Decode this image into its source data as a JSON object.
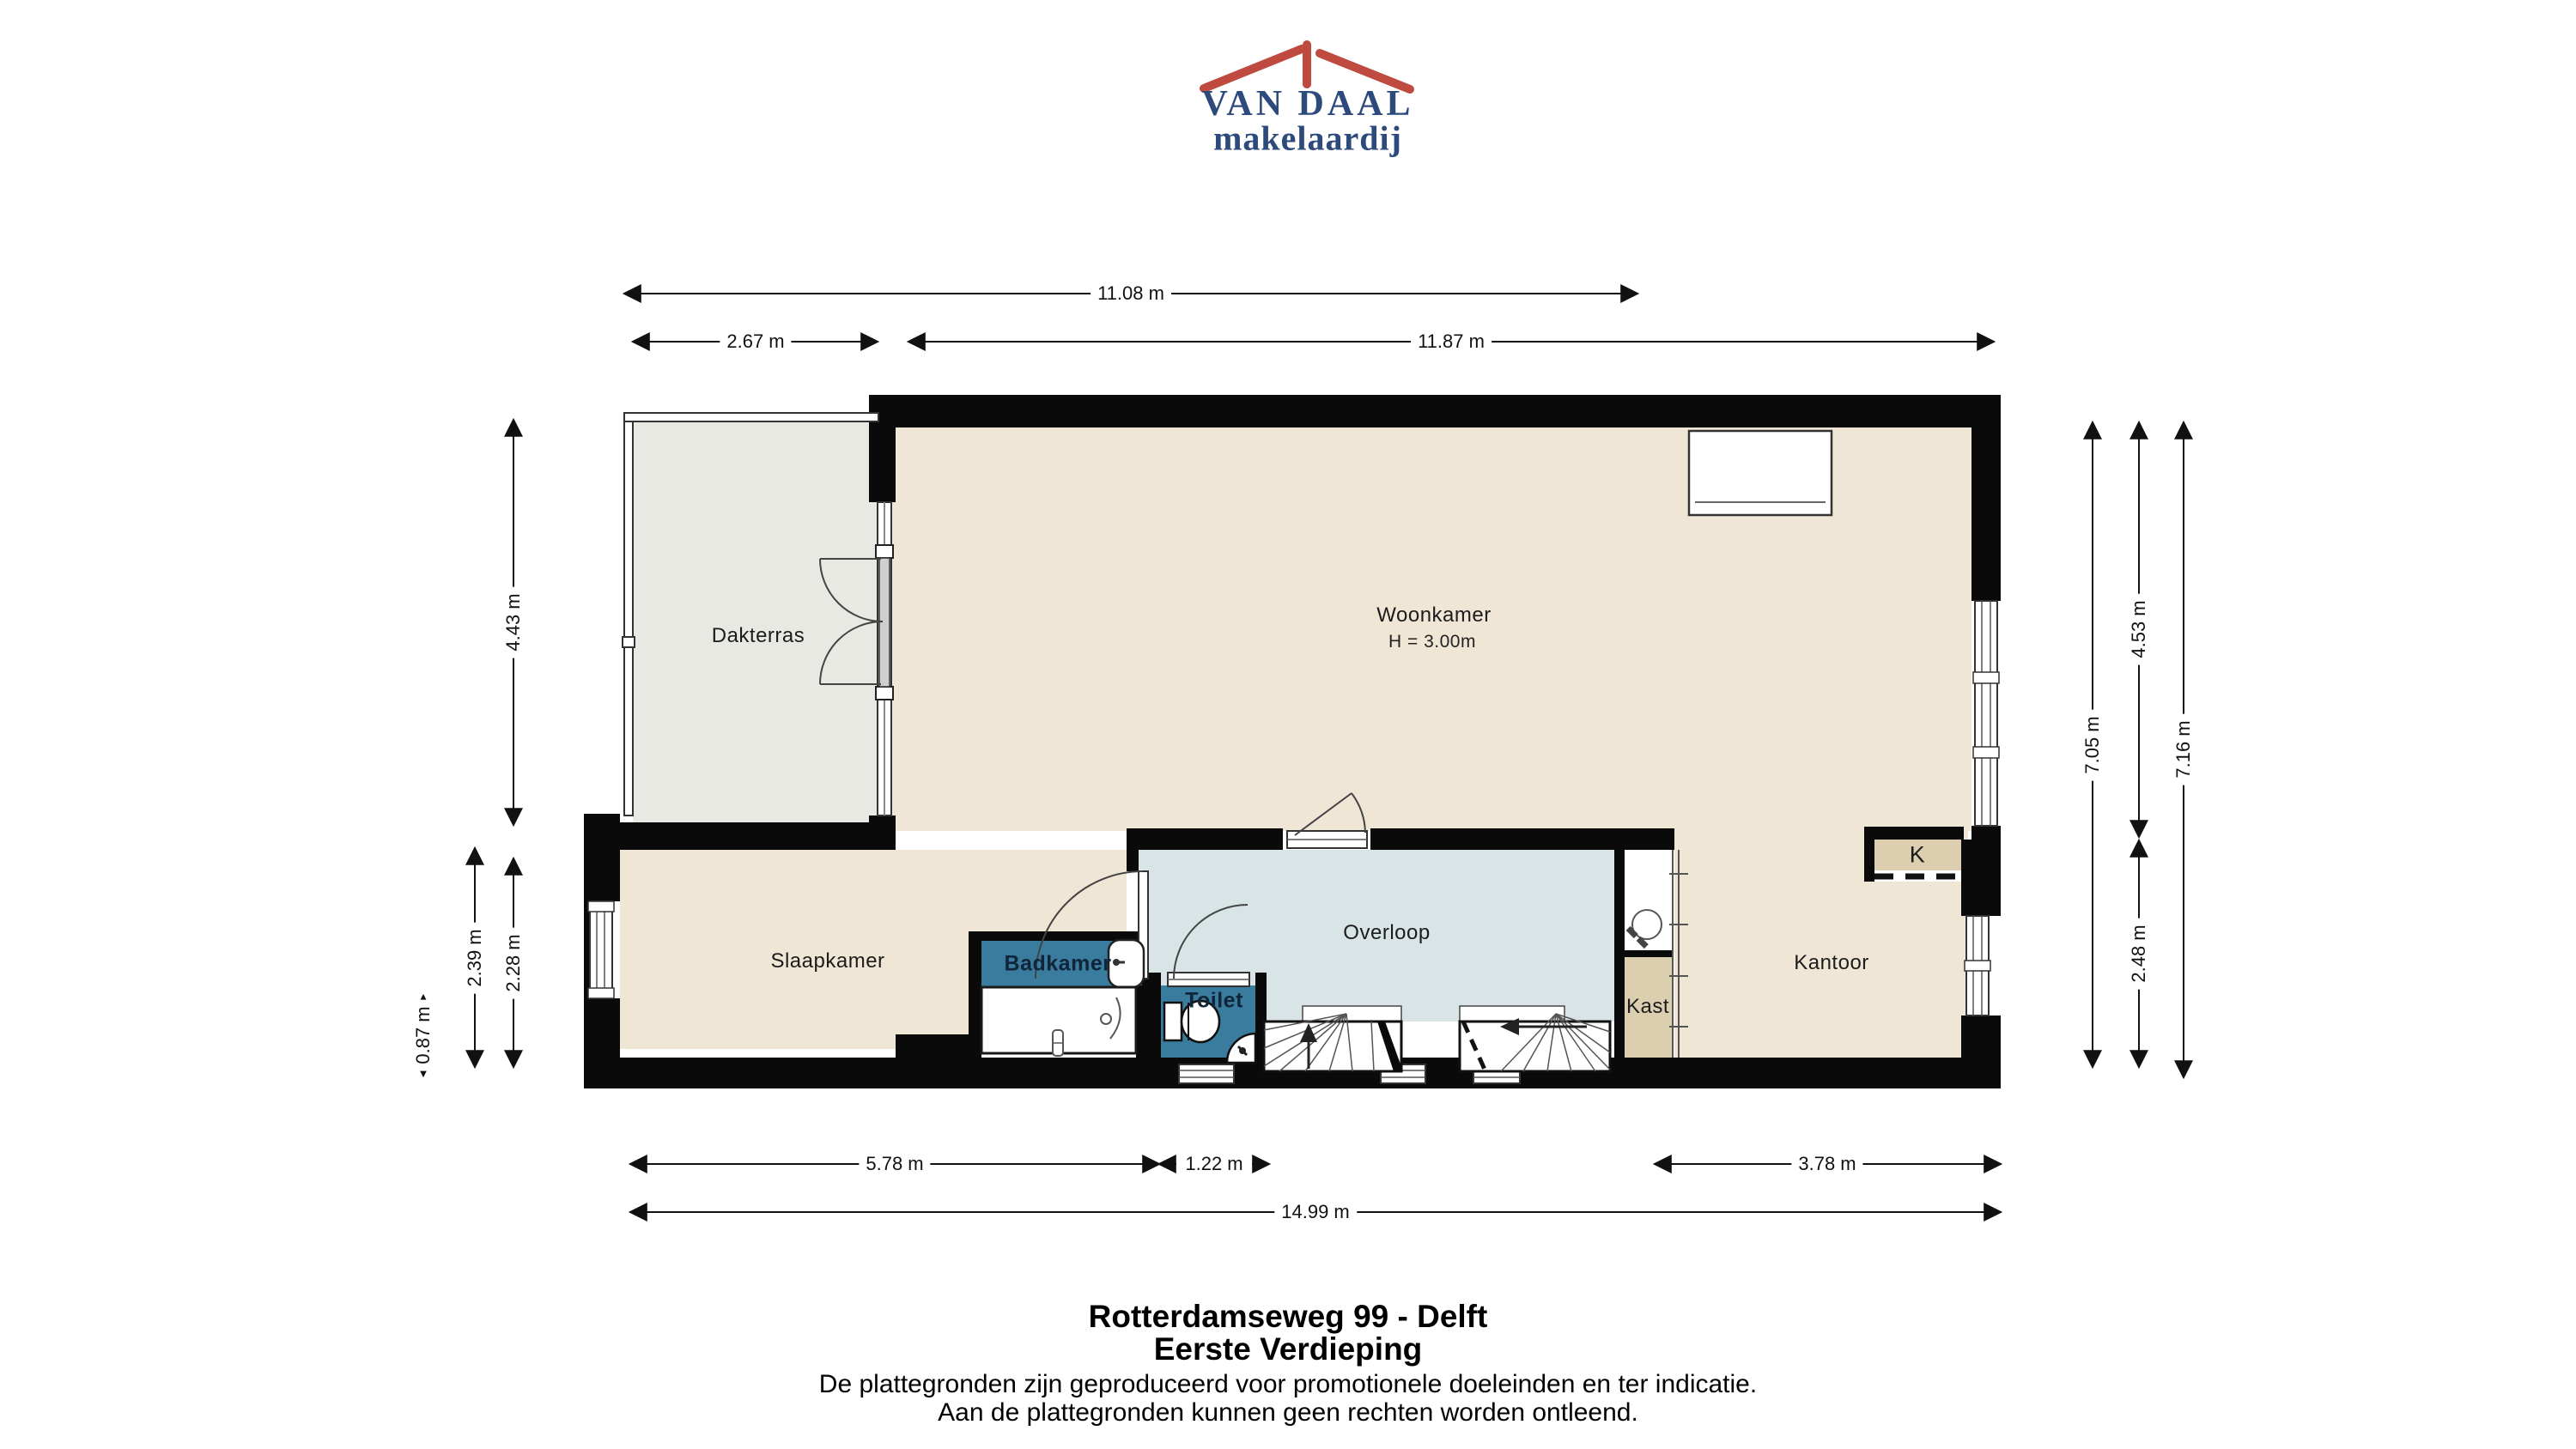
{
  "brand": {
    "name": "VAN DAAL",
    "tagline": "makelaardij"
  },
  "rooms": {
    "dakterras": "Dakterras",
    "woonkamer": "Woonkamer",
    "woonkamer_height": "H = 3.00m",
    "slaapkamer": "Slaapkamer",
    "badkamer": "Badkamer",
    "toilet": "Toilet",
    "overloop": "Overloop",
    "kast": "Kast",
    "kantoor": "Kantoor",
    "kitchenette": "K"
  },
  "dimensions": {
    "top_total": "11.08 m",
    "top_terrace": "2.67 m",
    "top_living": "11.87 m",
    "left_terrace": "4.43 m",
    "left_bedroom_outer": "2.39 m",
    "left_bedroom_inner": "2.28 m",
    "left_bay": "0.87 m",
    "right_inner": "7.05 m",
    "right_upper": "4.53 m",
    "right_lower": "2.48 m",
    "right_total": "7.16 m",
    "bottom_bedroom": "5.78 m",
    "bottom_toilet": "1.22 m",
    "bottom_office": "3.78 m",
    "bottom_total": "14.99 m"
  },
  "footer": {
    "address": "Rotterdamseweg 99 - Delft",
    "floor": "Eerste Verdieping",
    "disclaimer_line1": "De plattegronden zijn geproduceerd voor promotionele doeleinden en ter indicatie.",
    "disclaimer_line2": "Aan de plattegronden kunnen geen rechten worden ontleend."
  },
  "colors": {
    "wall": "#0a0a0a",
    "floor_living": "#f0e6d6",
    "floor_terrace": "#e9e9e4",
    "floor_hall": "#d8e4e6",
    "floor_wet": "#3a7c9d",
    "floor_closet": "#dccfb0",
    "brand_blue": "#2c4a7c",
    "brand_red": "#bf4a3f"
  }
}
